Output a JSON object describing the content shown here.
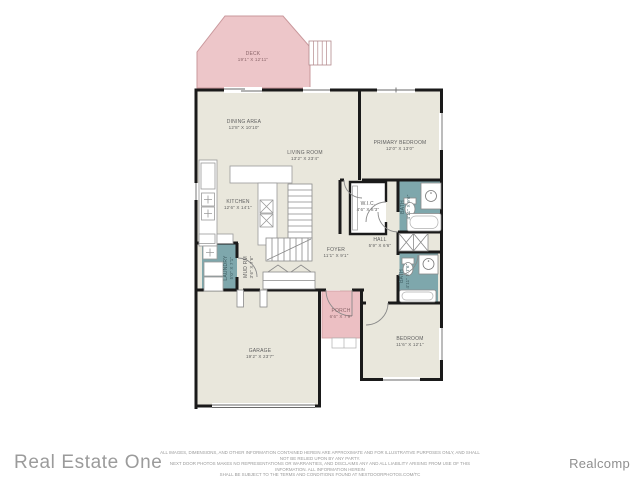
{
  "branding": {
    "agency": "Real Estate One",
    "mls": "Realcomp"
  },
  "disclaimer": {
    "line1": "ALL IMAGES, DIMENSIONS, AND OTHER INFORMATION CONTAINED HEREIN ARE APPROXIMATE AND FOR ILLUSTRATIVE PURPOSES ONLY, AND SHALL NOT BE RELIED UPON BY ANY PARTY.",
    "line2": "NEXT DOOR PHOTOS MAKES NO REPRESENTATIONS OR WARRANTIES, AND DISCLAIMS ANY AND ALL LIABILITY ARISING FROM USE OF THIS INFORMATION. ALL INFORMATION HEREIN",
    "line3": "SHALL BE SUBJECT TO THE TERMS AND CONDITIONS FOUND AT NEXTDOORPHOTOS.COM/TC"
  },
  "rooms": {
    "deck": {
      "name": "DECK",
      "dims": "19'1\" X 12'11\""
    },
    "dining": {
      "name": "DINING AREA",
      "dims": "12'8\" X 10'10\""
    },
    "living": {
      "name": "LIVING ROOM",
      "dims": "13'2\" X 23'4\""
    },
    "kitchen": {
      "name": "KITCHEN",
      "dims": "12'6\" X 14'1\""
    },
    "primary": {
      "name": "PRIMARY BEDROOM",
      "dims": "12'0\" X 13'0\""
    },
    "wic": {
      "name": "W.I.C.",
      "dims": "4'6\" X 8'3\""
    },
    "hall": {
      "name": "HALL",
      "dims": "5'9\" X 6'6\""
    },
    "foyer": {
      "name": "FOYER",
      "dims": "11'1\" X 9'1\""
    },
    "porch": {
      "name": "PORCH",
      "dims": "6'6\" X 7'9\""
    },
    "garage": {
      "name": "GARAGE",
      "dims": "19'2\" X 23'7\""
    },
    "bedroom": {
      "name": "BEDROOM",
      "dims": "11'6\" X 12'1\""
    },
    "laundry": {
      "name": "LAUNDRY",
      "dims": "5'0\" X 7'1\""
    },
    "mud": {
      "name": "MUD RM",
      "dims": "3'6\" X 7'6\""
    },
    "bath1": {
      "name": "BATH",
      "dims": "4'11\" X 9'6\""
    },
    "bath2": {
      "name": "BATH",
      "dims": "4'11\" X 7'6\""
    }
  },
  "colors": {
    "floor": "#e9e7dc",
    "deck_pink": "#edc6c9",
    "porch_pink": "#ecbfc3",
    "bath_teal": "#7ea7ac",
    "wall": "#1a1a1a",
    "label_text": "#5f5f5f",
    "logo_gray": "#9b9b9b"
  }
}
